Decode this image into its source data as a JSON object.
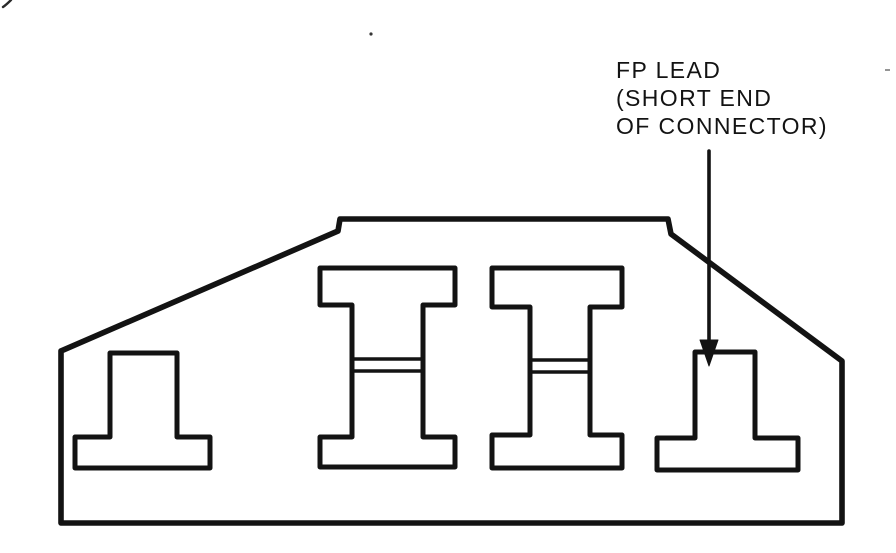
{
  "page": {
    "background_color": "#ffffff",
    "ink_color": "#131313"
  },
  "diagram": {
    "type": "technical-line-drawing",
    "subject": "connector cross-section showing lead cavities",
    "annotation": {
      "lines": [
        "FP LEAD",
        "(SHORT END",
        "OF CONNECTOR)"
      ],
      "points_to": "fp-lead-cavity (right pedestal, short end of connector)"
    },
    "shapes": [
      {
        "name": "connector-body-outline",
        "description": "trapezoidal housing outline with stepped top edge"
      },
      {
        "name": "lead-cavity-left",
        "description": "pedestal / inverted-T shaped cavity"
      },
      {
        "name": "ibeam-cavity-1",
        "description": "I-beam shaped cavity with double seam lines across web"
      },
      {
        "name": "ibeam-cavity-2",
        "description": "I-beam shaped cavity with double seam lines across web"
      },
      {
        "name": "fp-lead-cavity",
        "description": "pedestal / inverted-T shaped cavity indicated by arrow"
      }
    ]
  }
}
